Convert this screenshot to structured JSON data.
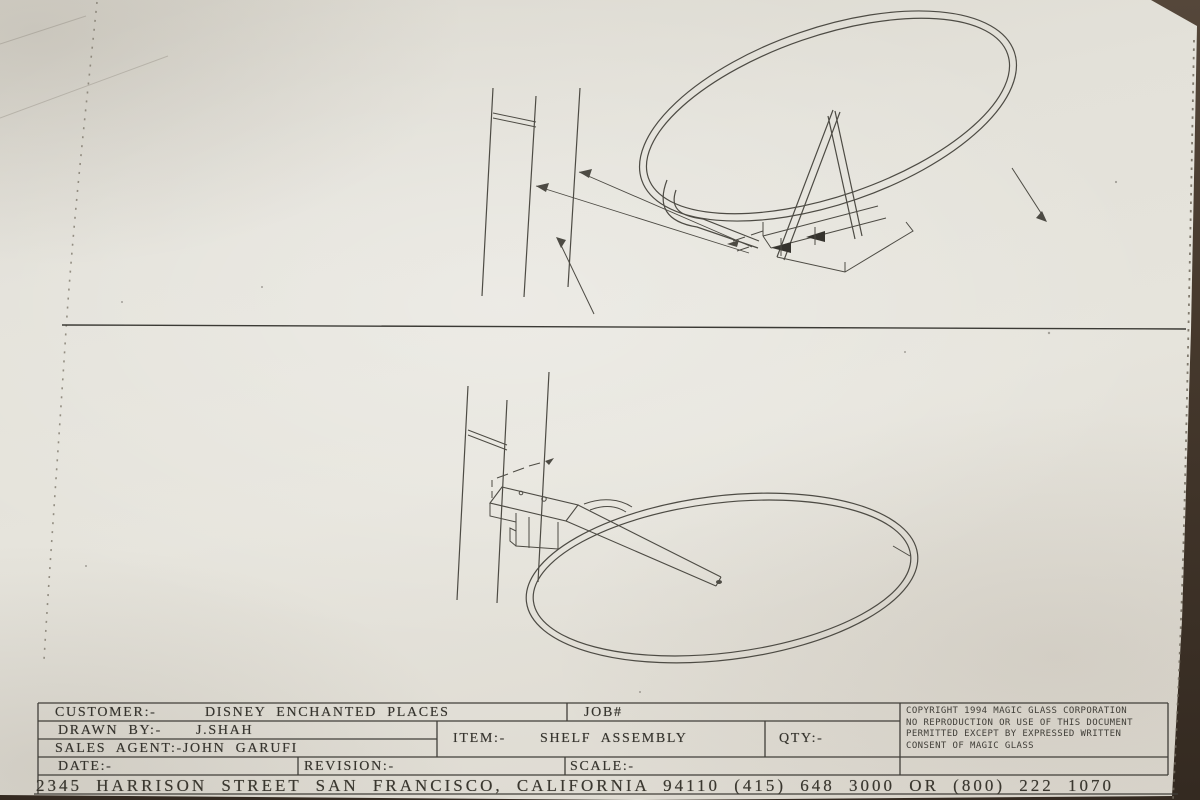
{
  "title_block": {
    "customer": {
      "label": "CUSTOMER:-",
      "value": "DISNEY ENCHANTED PLACES"
    },
    "job": {
      "label": "JOB#",
      "value": ""
    },
    "drawn_by": {
      "label": "DRAWN BY:-",
      "value": "J.SHAH"
    },
    "item": {
      "label": "ITEM:-",
      "value": "SHELF ASSEMBLY"
    },
    "qty": {
      "label": "QTY:-",
      "value": ""
    },
    "sales_agent": {
      "label": "SALES AGENT:-",
      "value": "JOHN GARUFI"
    },
    "date": {
      "label": "DATE:-",
      "value": ""
    },
    "revision": {
      "label": "REVISION:-",
      "value": ""
    },
    "scale": {
      "label": "SCALE:-",
      "value": ""
    },
    "copyright_lines": [
      "COPYRIGHT 1994 MAGIC GLASS CORPORATION",
      "NO REPRODUCTION OR USE OF THIS DOCUMENT",
      "PERMITTED EXCEPT BY EXPRESSED WRITTEN",
      "CONSENT OF MAGIC GLASS"
    ],
    "address_line": "2345 HARRISON STREET SAN FRANCISCO, CALIFORNIA 94110 (415) 648 3000 OR (800) 222 1070"
  },
  "drawing": {
    "views": [
      "upper-isometric-view",
      "lower-isometric-view"
    ]
  },
  "colors": {
    "paper": "#e3e1d9",
    "ink": "#4d4b44",
    "surround": "#46392d"
  }
}
